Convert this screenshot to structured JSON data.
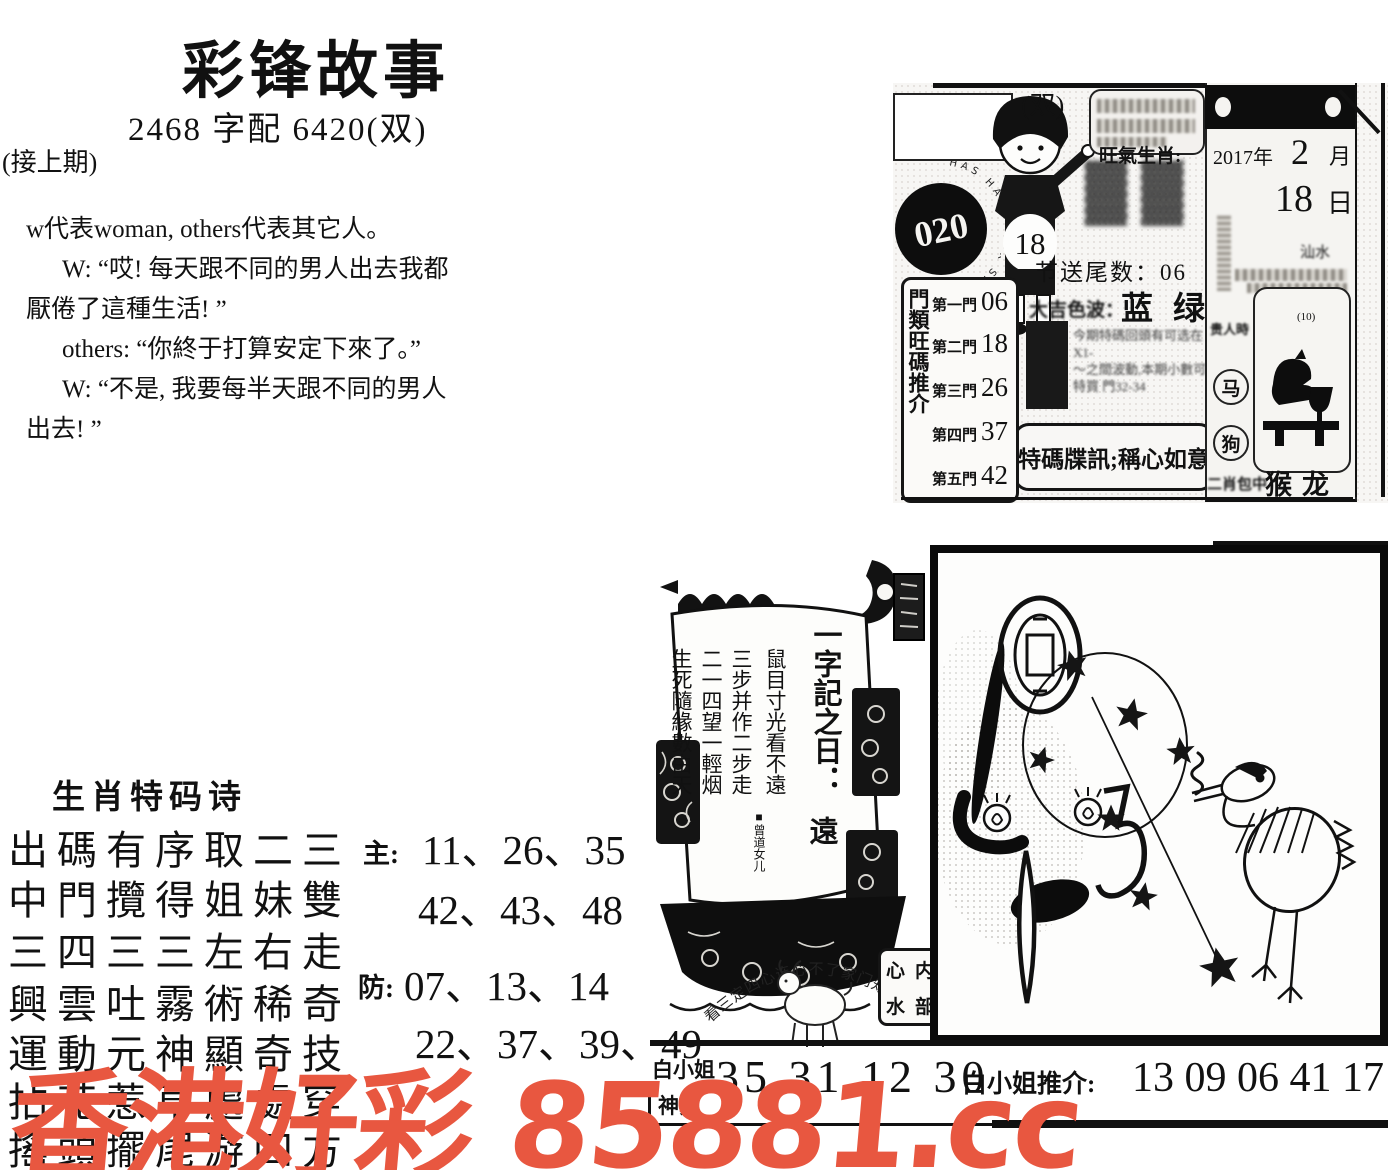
{
  "watermark": {
    "text": "香港好彩 85881.cc",
    "color": "#e85740"
  },
  "header": {
    "title": "彩锋故事",
    "subtitle": "2468 字配 6420(双)",
    "continued_note": "(接上期)"
  },
  "story": {
    "intro": "w代表woman, others代表其它人。",
    "lines": [
      "W: “哎! 每天跟不同的男人出去我都",
      "厭倦了這種生活! ”",
      "others: “你終于打算安定下來了。”",
      "W: “不是, 我要每半天跟不同的男人",
      "出去! ”"
    ]
  },
  "info_card": {
    "stamp_number": "020",
    "stamp_ring_text": "HAS HALLMARK SIX",
    "boy_number": "18",
    "double_tag": "(双)",
    "zodiac_label": "旺氣生肖:",
    "zodiac_glyphs": "▓▓",
    "tail_line": "节送尾数：06",
    "color_line_label": "大吉色波：",
    "color_line_value": "蓝 绿",
    "fine_print": [
      "今期特碼回頭有可选在X1-",
      "～之間波動,本期小數可",
      "特買 門32-34"
    ],
    "special_line": "特碼牒訊;稱心如意",
    "gate_box": {
      "vertical_label": "門類旺碼推介",
      "rows": [
        {
          "gate": "第一門",
          "num": "06"
        },
        {
          "gate": "第二門",
          "num": "18"
        },
        {
          "gate": "第三門",
          "num": "26"
        },
        {
          "gate": "第四門",
          "num": "37"
        },
        {
          "gate": "第五門",
          "num": "42"
        }
      ]
    },
    "calendar": {
      "year": "2017年",
      "month": "2",
      "month_unit": "月",
      "day": "18",
      "day_unit": "日",
      "side_note": "汕水",
      "noble_label": "贵人時",
      "tiny_note": "(10)",
      "circle_1": "马",
      "circle_2": "狗",
      "bottom_label": "二肖包中",
      "bottom_value": "猴龙"
    }
  },
  "ship": {
    "sail_title": "一字記之日：",
    "sail_word": "遠",
    "sail_lines": [
      "鼠目寸光看不遠",
      "三步并作二步走",
      "二一四望一輕烟",
      "生死隨緣數由天"
    ],
    "signature": "■曾道女儿",
    "goat_arc_text": "看三定四心连心不了家门知世情",
    "seal_grid": [
      "心",
      "内",
      "水",
      "部"
    ]
  },
  "poem": {
    "title": "生肖特码诗",
    "lines": [
      "出碼有序取二三",
      "中門攬得姐妹雙",
      "三四三三左右走",
      "興雲吐霧術稀奇",
      "運動元神顯奇技",
      "拈花惹草處處穿",
      "搖頭擺尾游四方"
    ],
    "main_label": "主:",
    "main_rows": [
      "11、26、35",
      "42、43、48"
    ],
    "guard_label": "防:",
    "guard_rows": [
      "07、13、14",
      "22、37、39、49"
    ]
  },
  "bottom_bar": {
    "name_top": "白小姐",
    "name_bottom": "神算",
    "numbers": "35 31 12 30",
    "tip_label": "白小姐推介:",
    "tip_numbers": "13 09 06 41 17"
  }
}
